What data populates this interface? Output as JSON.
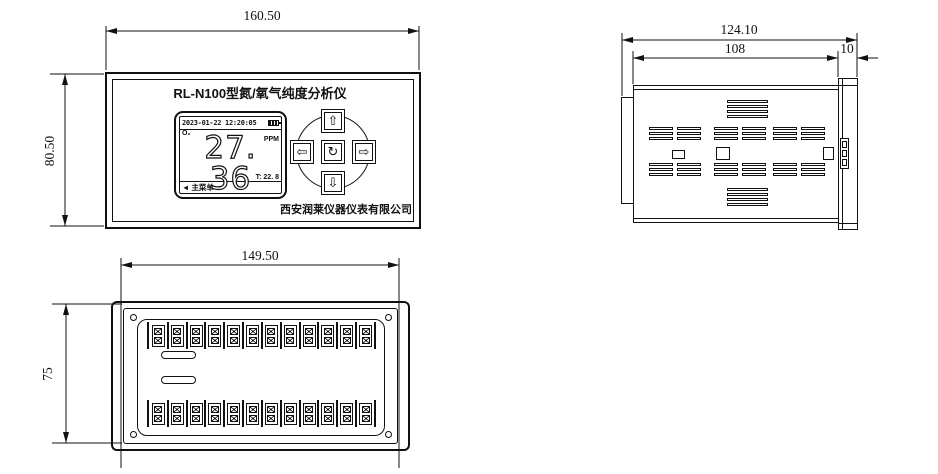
{
  "front_view": {
    "width_dim": "160.50",
    "height_dim": "80.50",
    "device_title": "RL-N100型氮/氧气纯度分析仪",
    "lcd": {
      "datetime": "2023-01-22 12:20:05",
      "gas": "O₂",
      "unit": "PPM",
      "reading": "27. 36",
      "temperature": "T: 22. 8",
      "menu_arrow": "◄",
      "menu_label": "主菜单"
    },
    "keypad": {
      "up": "⇧",
      "down": "⇩",
      "left": "⇦",
      "right": "⇨",
      "center": "↻"
    },
    "company": "西安润莱仪器仪表有限公司"
  },
  "side_view": {
    "overall_depth_dim": "124.10",
    "case_depth_dim": "108",
    "bezel_depth_dim": "10"
  },
  "back_view": {
    "width_dim": "149.50",
    "height_dim": "75",
    "terminals_per_row": 12,
    "terminal_rows": 2
  }
}
